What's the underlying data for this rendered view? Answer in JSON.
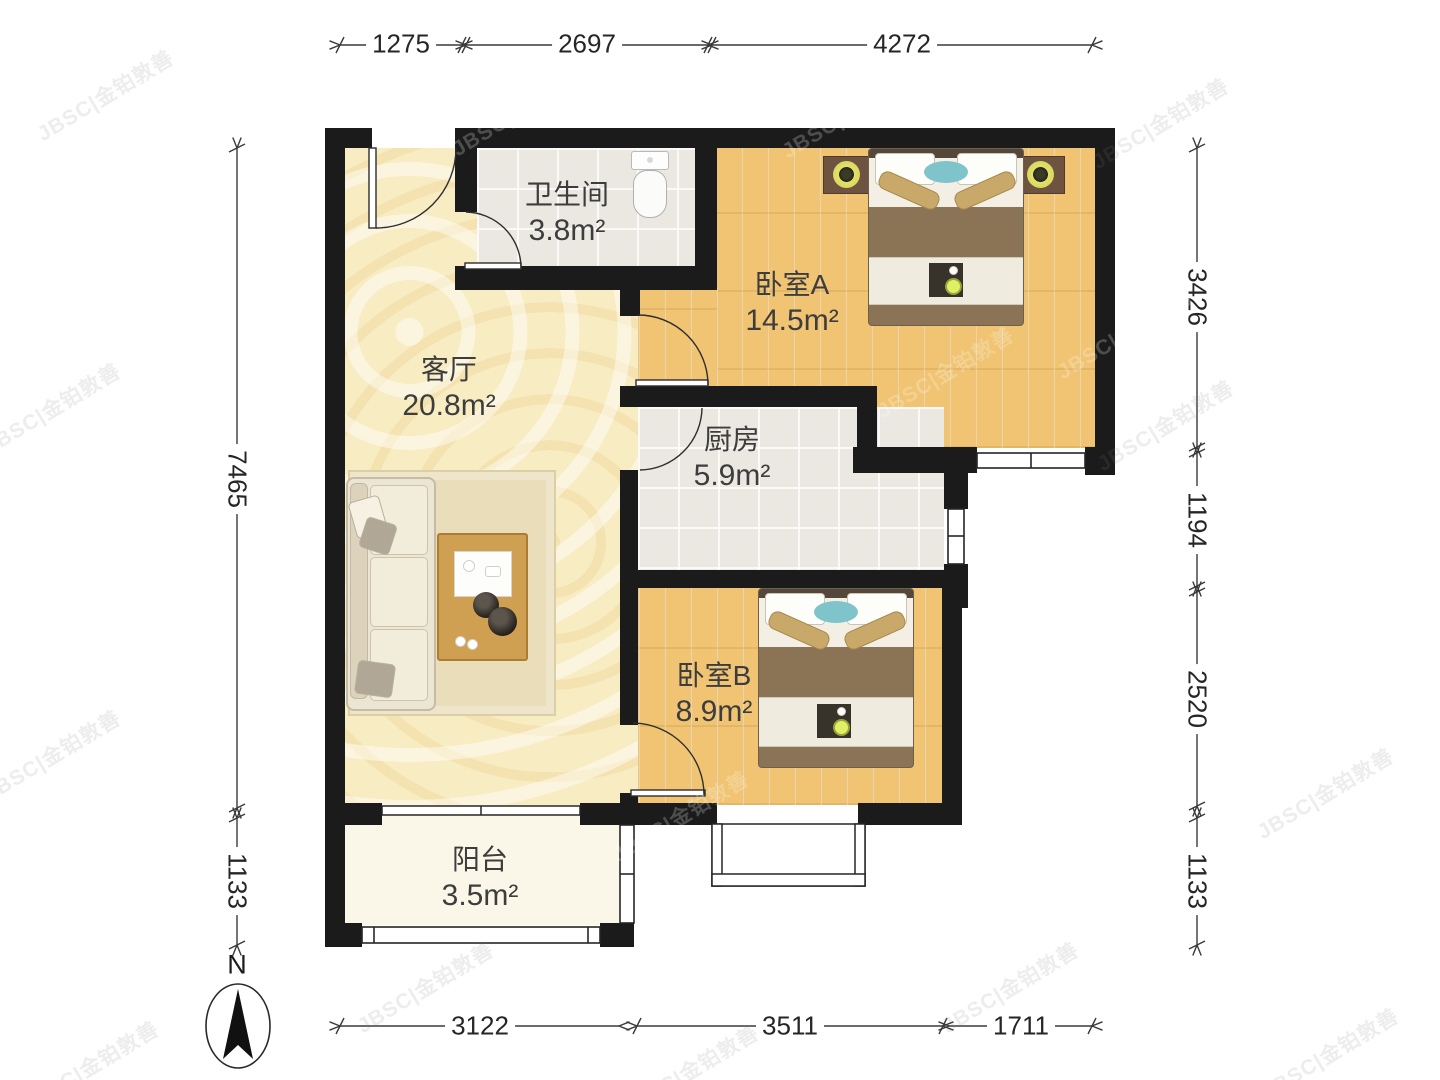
{
  "floorplan": {
    "title": "两室一厅户型图",
    "rooms": [
      {
        "id": "bathroom",
        "name": "卫生间",
        "area": "3.8m²"
      },
      {
        "id": "bedroom_a",
        "name": "卧室A",
        "area": "14.5m²"
      },
      {
        "id": "living_room",
        "name": "客厅",
        "area": "20.8m²"
      },
      {
        "id": "kitchen",
        "name": "厨房",
        "area": "5.9m²"
      },
      {
        "id": "bedroom_b",
        "name": "卧室B",
        "area": "8.9m²"
      },
      {
        "id": "balcony",
        "name": "阳台",
        "area": "3.5m²"
      }
    ],
    "dimensions_mm": {
      "top": [
        "1275",
        "2697",
        "4272"
      ],
      "bottom": [
        "3122",
        "3511",
        "1711"
      ],
      "left": [
        "7465",
        "1133"
      ],
      "right": [
        "3426",
        "1194",
        "2520",
        "1133"
      ]
    },
    "compass": {
      "label": "N"
    },
    "watermark": {
      "text": "JBSC|金铂敦善"
    },
    "colors": {
      "wall": "#1b1b1b",
      "wood_floor": "#f0c472",
      "marble_floor": "#f8ecc3",
      "tile_floor": "#ebe8e1",
      "balcony_floor": "#fbf7e8",
      "dimension_text": "#262626"
    }
  }
}
